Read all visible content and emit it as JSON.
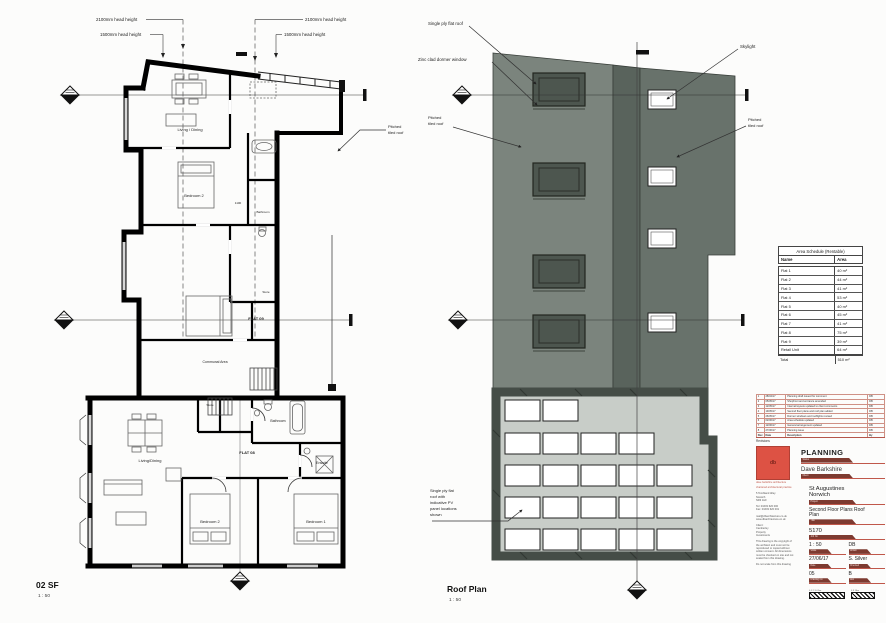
{
  "colors": {
    "logo_red": "#dd5244",
    "bar_maroon": "#7d3a30",
    "rule_red": "#c0574a",
    "roof_left": "#7b847d",
    "roof_band": "#59635c",
    "roof_right": "#68726b",
    "dormer": "#4d564f",
    "flat_roof_wall": "#454d47",
    "flat_roof_field": "#c8cdc8"
  },
  "floor_plan": {
    "title": "02 SF",
    "scale": "1 : 50",
    "ann": {
      "hh2100l": "2100mm head height",
      "hh1500l": "1500mm head height",
      "hh2100r": "2100mm head height",
      "hh1500r": "1500mm head height",
      "pitched1": "Pitched",
      "pitched2": "tiled roof"
    },
    "rooms": {
      "living_up": "Living / Dining",
      "bed2_up": "Bedroom 2",
      "dim1100": "1100",
      "bath_up": "Bathroom",
      "store_up": "Store",
      "flat09": "FLAT 09",
      "communal": "Communal Area",
      "store_lo": "Store",
      "bath_lo": "Bathroom",
      "flat08": "FLAT 08",
      "living_lo": "Living/Dining",
      "ensuite": "Ensuite",
      "bed2_lo": "Bedroom 2",
      "bed1_lo": "Bedroom 1"
    }
  },
  "roof_plan": {
    "title": "Roof Plan",
    "scale": "1 : 50",
    "ann": {
      "single_ply": "Single ply flat roof",
      "dormer": "Zinc clad dormer window",
      "skylight": "Skylight",
      "pitched_l1": "Pitched",
      "pitched_l2": "tiled roof",
      "pitched_r1": "Pitched",
      "pitched_r2": "tiled roof",
      "pv1": "Single ply flat",
      "pv2": "roof with",
      "pv3": "indicative PV",
      "pv4": "panel locations",
      "pv5": "shown"
    }
  },
  "area_schedule": {
    "title": "Area Schedule (Rentable)",
    "col_name": "Name",
    "col_area": "Area",
    "rows": [
      [
        "Flat 1",
        "40 m²"
      ],
      [
        "Flat 2",
        "44 m²"
      ],
      [
        "Flat 3",
        "41 m²"
      ],
      [
        "Flat 4",
        "53 m²"
      ],
      [
        "Flat 5",
        "40 m²"
      ],
      [
        "Flat 6",
        "45 m²"
      ],
      [
        "Flat 7",
        "41 m²"
      ],
      [
        "Flat 8",
        "75 m²"
      ],
      [
        "Flat 9",
        "39 m²"
      ],
      [
        "Retail Unit",
        "64 m²"
      ]
    ],
    "total_name": "Total",
    "total_area": "510 m²"
  },
  "title_block": {
    "revisions_label": "Revisions",
    "rev_header": [
      "Rev",
      "Date",
      "Description",
      "By"
    ],
    "rev_rows": [
      [
        "1",
        "28/04/17",
        "Planning draft issued for comment",
        "DB"
      ],
      [
        "2",
        "05/05/17",
        "Shopfront and entrance amended",
        "DB"
      ],
      [
        "3",
        "12/05/17",
        "Internal layouts updated to client comments",
        "DB"
      ],
      [
        "4",
        "19/05/17",
        "Second floor plans and roof plan added",
        "DB"
      ],
      [
        "5",
        "26/05/17",
        "Dormer windows and rooflights revised",
        "DB"
      ],
      [
        "6",
        "02/06/17",
        "Area schedule updated",
        "DB"
      ],
      [
        "7",
        "12/06/17",
        "General arrangement updated",
        "DB"
      ],
      [
        "8",
        "27/06/17",
        "Planning issue",
        "DB"
      ]
    ],
    "status": "PLANNING",
    "labels": {
      "status": "Status",
      "client": "Client",
      "project": "Project",
      "title": "Title",
      "job": "Job No",
      "scale": "Scale",
      "drawn": "Drawn",
      "date": "Date",
      "checked": "Checked",
      "dwg": "Drawing No",
      "rev": "Rev"
    },
    "client_name": "Dave Barkshire",
    "logo_text": "db",
    "logo_caption": "dave barkshire architecture",
    "practice_note": "chartered architectural practice",
    "address": [
      "5 Tombland Alley",
      "Norwich",
      "NR3 1HF"
    ],
    "contact": [
      "Tel:  01603 620 000",
      "Fax: 01603 620 001"
    ],
    "web": [
      "mail@dbarchitecture.co.uk",
      "www.dbarchitecture.co.uk"
    ],
    "client_block": [
      "Client:",
      "Camberley",
      "Property",
      "Investments"
    ],
    "copyright": [
      "This drawing is the copyright of",
      "the architect and must not be",
      "reproduced or copied without",
      "written consent. All dimensions",
      "must be checked on site and not",
      "scaled from this drawing."
    ],
    "noscale": "Do not scale from this drawing",
    "project_l1": "St Augustines",
    "project_l2": "Norwich",
    "title_l1": "Second Floor Plans Roof",
    "title_l2": "Plan",
    "job_no": "5170",
    "scale_val": "1 : 50",
    "drawn_val": "DB",
    "date_val": "27/06/17",
    "checked_val": "S. Silver",
    "dwg_val": "05",
    "rev_val": "B",
    "scalebar1": "0 1 2 3 4 5m",
    "scalebar2": "0 5 10m"
  }
}
